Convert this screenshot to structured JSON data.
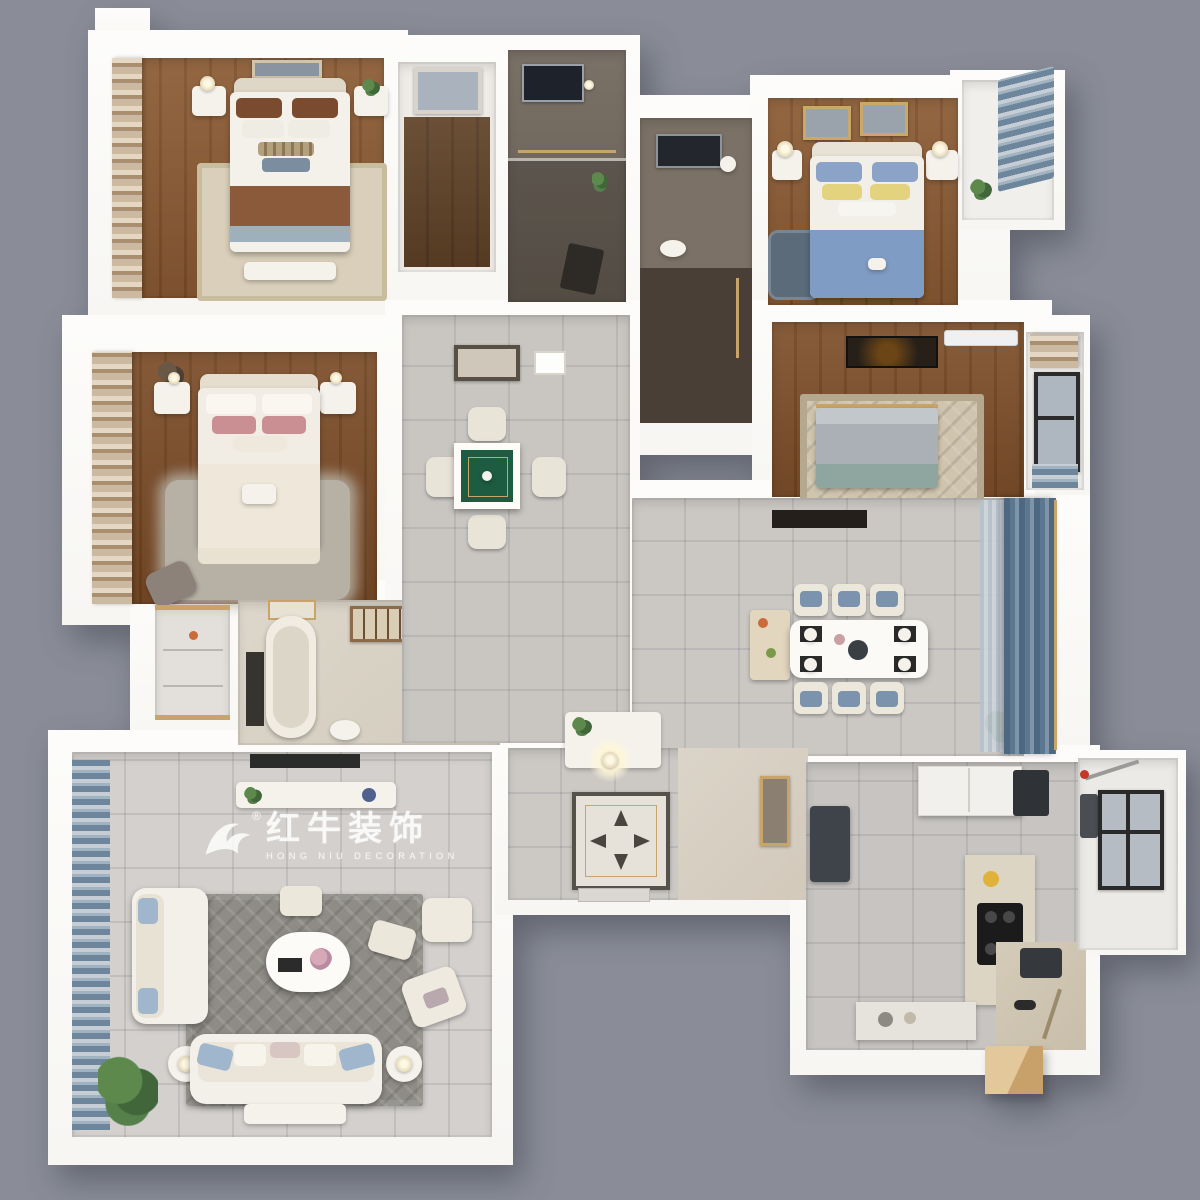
{
  "watermark": {
    "registered_mark": "®",
    "brand_cn": "红牛装饰",
    "brand_en": "HONG NIU DECORATION"
  },
  "palette": {
    "background": "#8a8d98",
    "wall": "#f7f6f3",
    "wall_hi": "#fdfcfa",
    "tile_light": "#d3d0cd",
    "tile_mid": "#c7c4c1",
    "tile_foyer": "#ccc9c5",
    "wood_a": "#8a5a32",
    "wood_b": "#7c4e29",
    "rug_dark": "#8f8c86",
    "bed_blue": "#7f9cc4",
    "curtain_blue": "#5d7791",
    "mahjong_green": "#1d5c40",
    "marble_dark": "#6f665c",
    "gold": "#c8a469"
  }
}
